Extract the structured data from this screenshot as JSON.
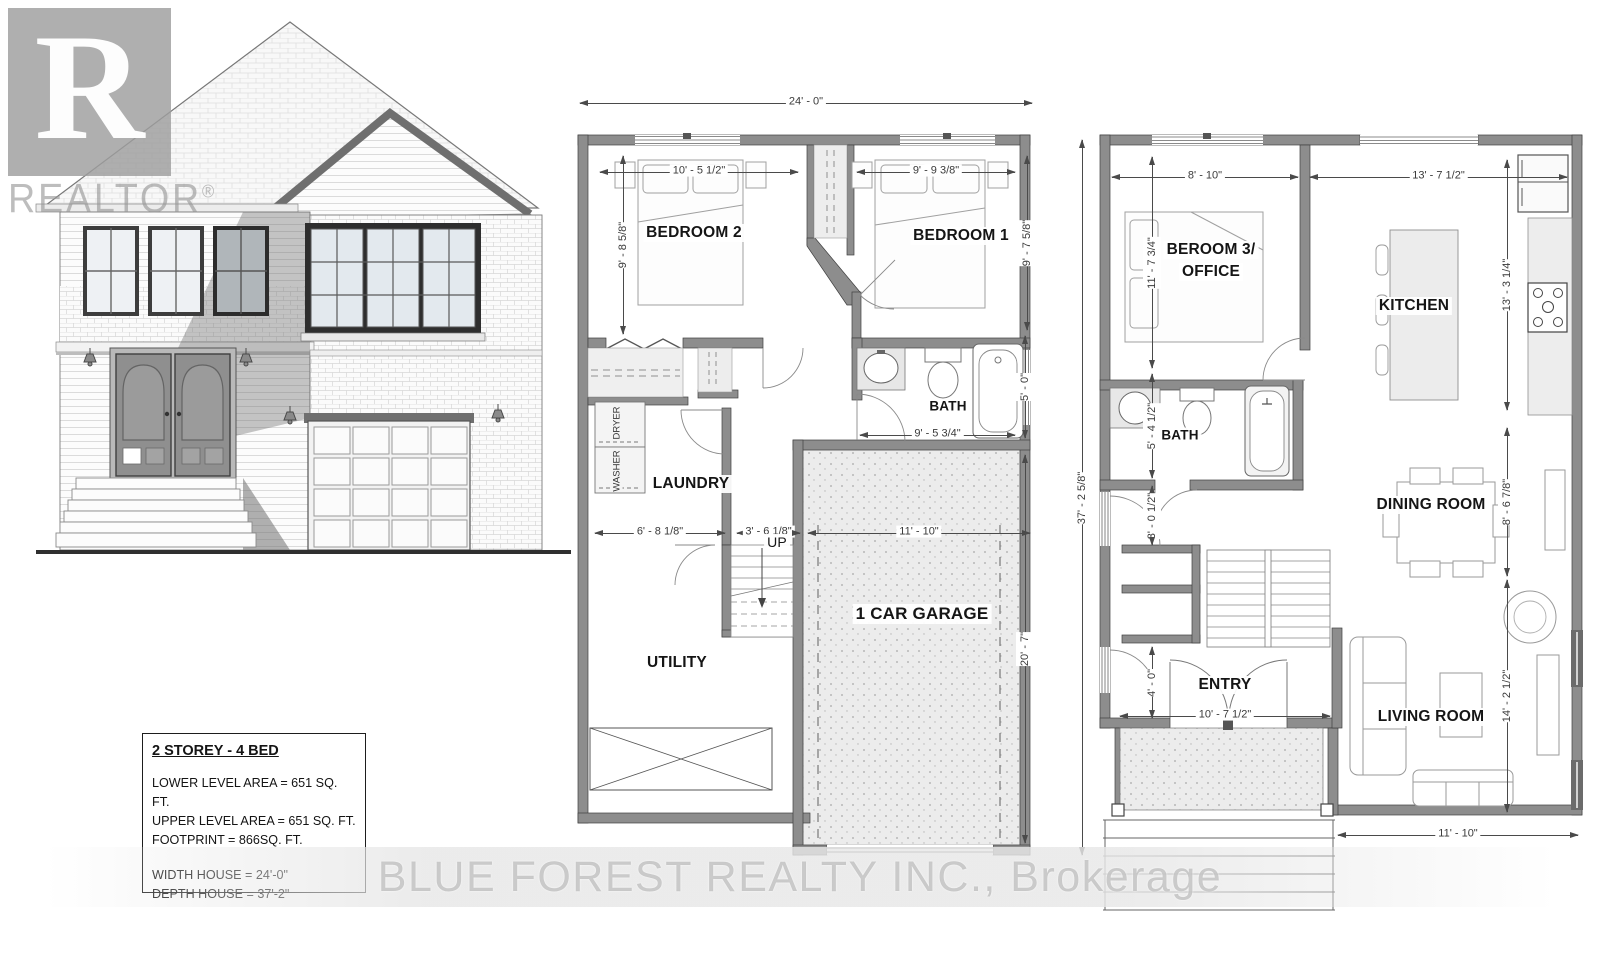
{
  "watermarks": {
    "logo_letter": "R",
    "logo_text": "REALTOR",
    "logo_reg": "®",
    "brokerage": "BLUE FOREST REALTY INC., Brokerage"
  },
  "info_box": {
    "title": "2 STOREY - 4 BED",
    "area_lines": [
      "LOWER LEVEL AREA = 651 SQ. FT.",
      "UPPER LEVEL AREA = 651 SQ. FT.",
      "FOOTPRINT = 866SQ. FT."
    ],
    "size_lines": [
      "WIDTH HOUSE = 24'-0\"",
      "DEPTH HOUSE = 37'-2\""
    ]
  },
  "lower_plan": {
    "labels": {
      "bedroom2": "BEDROOM 2",
      "bedroom1": "BEDROOM 1",
      "bath": "BATH",
      "laundry": "LAUNDRY",
      "washer": "WASHER",
      "dryer": "DRYER",
      "up": "UP",
      "utility": "UTILITY",
      "garage": "1 CAR GARAGE"
    },
    "dims": {
      "overall_width": "24' - 0\"",
      "overall_depth": "37' - 2 5/8\"",
      "bedroom2_w": "10' - 5 1/2\"",
      "bedroom2_h": "9' - 8 5/8\"",
      "bedroom1_w": "9' - 9 3/8\"",
      "bedroom1_h": "9' - 7 5/8\"",
      "bath_w": "9' - 5 3/4\"",
      "bath_h": "5' - 0\"",
      "laundry_w": "6' - 8 1/8\"",
      "hall_w": "3' - 6 1/8\"",
      "garage_w": "11' - 10\"",
      "garage_h": "20' - 7\""
    }
  },
  "upper_plan": {
    "labels": {
      "beroom3_line1": "BEROOM 3/",
      "beroom3_line2": "OFFICE",
      "kitchen": "KITCHEN",
      "bath": "BATH",
      "dining": "DINING ROOM",
      "entry": "ENTRY",
      "living": "LIVING ROOM"
    },
    "dims": {
      "top_left": "8' - 10\"",
      "top_right": "13' - 7 1/2\"",
      "beroom3_h": "11' - 7 3/4\"",
      "kitchen_h": "13' - 3 1/4\"",
      "bath_h": "5' - 4 1/2\"",
      "hall_h": "3' - 0 1/2\"",
      "dining_h": "8' - 6 7/8\"",
      "entry_h": "4' - 0\"",
      "entry_w": "10' - 7 1/2\"",
      "living_h": "14' - 2 1/2\"",
      "living_w": "11' - 10\""
    }
  }
}
